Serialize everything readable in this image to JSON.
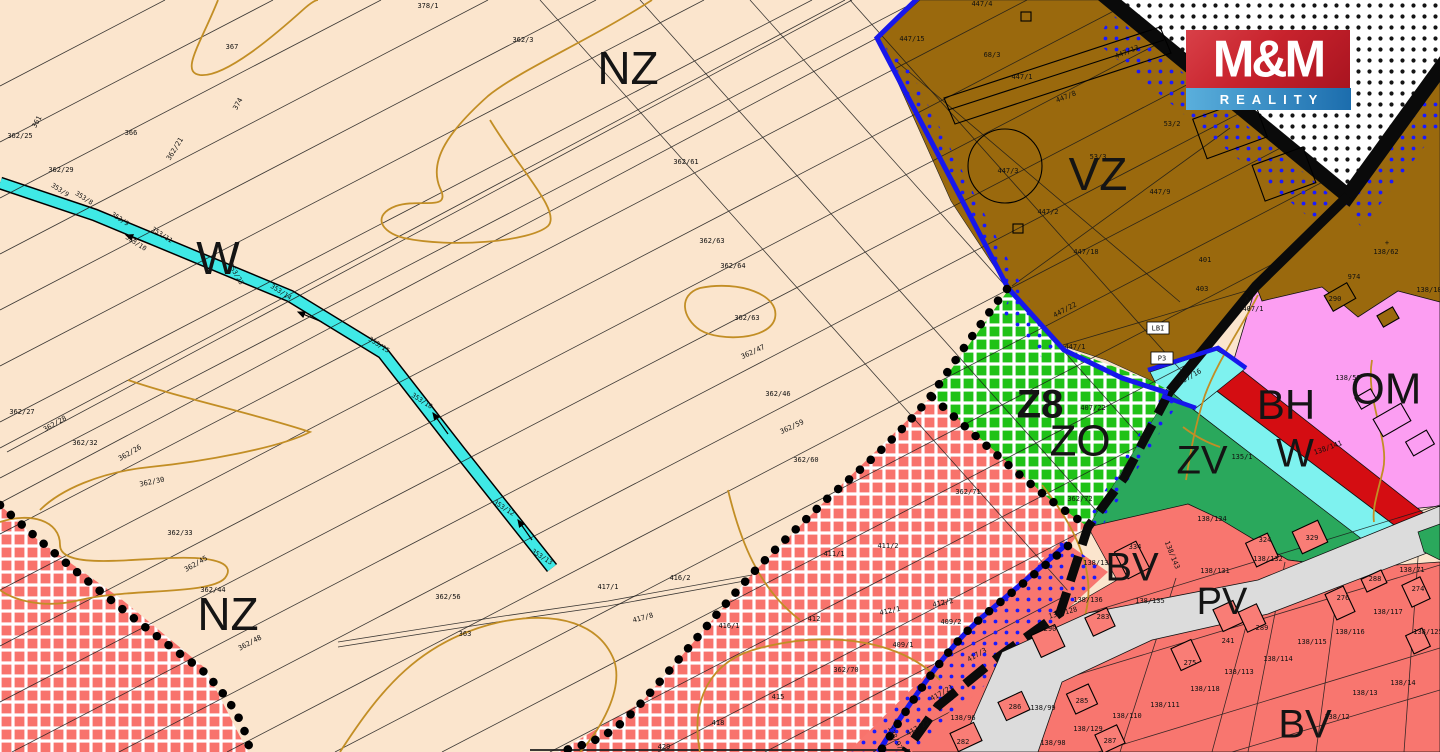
{
  "app": {
    "title": "Zoning plan map with realty watermark"
  },
  "logo": {
    "line1": "M&M",
    "line2": "REALITY"
  },
  "colors": {
    "beige": "#fbe5cd",
    "brown_vz": "#9a690d",
    "green_hatch_zo": "#1fc217",
    "green_solid_zv": "#2aa85c",
    "red_hatch": "#f8736c",
    "salmon_bv": "#f8766f",
    "pink_om": "#fc9ef2",
    "red_band_bh": "#d40d12",
    "cyan_stream": "#3fe9e6",
    "cyan_band_w": "#7ef2ef",
    "gray_road_pv": "#dcdcdc",
    "contour_gold": "#c28e25",
    "blue_border": "#1717ec",
    "magenta_z8": "#e312cf",
    "logo_red": "#c8232d",
    "logo_blue1": "#5aafdc",
    "logo_blue2": "#1c6dad"
  },
  "zone_labels": [
    {
      "t": "NZ",
      "x": 628,
      "y": 72,
      "s": 46
    },
    {
      "t": "NZ",
      "x": 228,
      "y": 618,
      "s": 46
    },
    {
      "t": "W",
      "x": 218,
      "y": 262,
      "s": 46
    },
    {
      "t": "VZ",
      "x": 1098,
      "y": 178,
      "s": 46
    },
    {
      "t": "Z8",
      "x": 1040,
      "y": 407,
      "s": 40,
      "c": "#e312cf",
      "w": "bold"
    },
    {
      "t": "ZO",
      "x": 1080,
      "y": 444,
      "s": 44
    },
    {
      "t": "ZV",
      "x": 1202,
      "y": 463,
      "s": 40
    },
    {
      "t": "BH",
      "x": 1286,
      "y": 408,
      "s": 42
    },
    {
      "t": "W",
      "x": 1295,
      "y": 456,
      "s": 40
    },
    {
      "t": "OM",
      "x": 1386,
      "y": 392,
      "s": 44
    },
    {
      "t": "BV",
      "x": 1132,
      "y": 570,
      "s": 40
    },
    {
      "t": "PV",
      "x": 1222,
      "y": 604,
      "s": 38
    },
    {
      "t": "BV",
      "x": 1305,
      "y": 727,
      "s": 40
    }
  ],
  "parcel_labels": [
    {
      "t": "367",
      "x": 232,
      "y": 47
    },
    {
      "t": "378/1",
      "x": 428,
      "y": 6
    },
    {
      "t": "362/3",
      "x": 523,
      "y": 40
    },
    {
      "t": "366",
      "x": 131,
      "y": 133
    },
    {
      "t": "362/25",
      "x": 20,
      "y": 136
    },
    {
      "t": "361",
      "x": 37,
      "y": 122,
      "r": -62
    },
    {
      "t": "362/29",
      "x": 61,
      "y": 170
    },
    {
      "t": "362/21",
      "x": 175,
      "y": 149,
      "r": -58
    },
    {
      "t": "374",
      "x": 238,
      "y": 104,
      "r": -62
    },
    {
      "t": "362/61",
      "x": 686,
      "y": 162
    },
    {
      "t": "362/63",
      "x": 712,
      "y": 241
    },
    {
      "t": "362/64",
      "x": 733,
      "y": 266
    },
    {
      "t": "362/63",
      "x": 747,
      "y": 318
    },
    {
      "t": "362/47",
      "x": 753,
      "y": 352,
      "r": -25
    },
    {
      "t": "362/46",
      "x": 778,
      "y": 394
    },
    {
      "t": "362/59",
      "x": 792,
      "y": 427,
      "r": -25
    },
    {
      "t": "362/60",
      "x": 806,
      "y": 460
    },
    {
      "t": "362/27",
      "x": 22,
      "y": 412
    },
    {
      "t": "362/28",
      "x": 55,
      "y": 424,
      "r": -30
    },
    {
      "t": "362/32",
      "x": 85,
      "y": 443
    },
    {
      "t": "362/26",
      "x": 130,
      "y": 453,
      "r": -30
    },
    {
      "t": "362/30",
      "x": 152,
      "y": 482,
      "r": -12
    },
    {
      "t": "362/33",
      "x": 180,
      "y": 533
    },
    {
      "t": "362/45",
      "x": 196,
      "y": 564,
      "r": -30
    },
    {
      "t": "362/44",
      "x": 213,
      "y": 590
    },
    {
      "t": "362/48",
      "x": 250,
      "y": 643,
      "r": -28
    },
    {
      "t": "362/56",
      "x": 448,
      "y": 597
    },
    {
      "t": "363",
      "x": 465,
      "y": 634
    },
    {
      "t": "417/1",
      "x": 608,
      "y": 587
    },
    {
      "t": "416/2",
      "x": 680,
      "y": 578
    },
    {
      "t": "417/8",
      "x": 643,
      "y": 618,
      "r": -15
    },
    {
      "t": "416/1",
      "x": 729,
      "y": 626
    },
    {
      "t": "412",
      "x": 814,
      "y": 619
    },
    {
      "t": "411/1",
      "x": 834,
      "y": 554
    },
    {
      "t": "411/2",
      "x": 888,
      "y": 546
    },
    {
      "t": "412/1",
      "x": 890,
      "y": 611,
      "r": -12
    },
    {
      "t": "412/2",
      "x": 943,
      "y": 603,
      "r": -12
    },
    {
      "t": "409/2",
      "x": 951,
      "y": 622
    },
    {
      "t": "409/1",
      "x": 903,
      "y": 645
    },
    {
      "t": "362/70",
      "x": 846,
      "y": 670
    },
    {
      "t": "415",
      "x": 778,
      "y": 697
    },
    {
      "t": "418",
      "x": 718,
      "y": 723
    },
    {
      "t": "429",
      "x": 664,
      "y": 747
    },
    {
      "t": "362/71",
      "x": 968,
      "y": 492
    },
    {
      "t": "362/72",
      "x": 1080,
      "y": 499
    },
    {
      "t": "447/4",
      "x": 982,
      "y": 4
    },
    {
      "t": "447/15",
      "x": 912,
      "y": 39
    },
    {
      "t": "68/3",
      "x": 992,
      "y": 55
    },
    {
      "t": "447/1",
      "x": 1022,
      "y": 77
    },
    {
      "t": "447/8",
      "x": 1066,
      "y": 97,
      "r": -22
    },
    {
      "t": "447/13",
      "x": 1127,
      "y": 52,
      "r": -22
    },
    {
      "t": "53/2",
      "x": 1172,
      "y": 124
    },
    {
      "t": "53/3",
      "x": 1098,
      "y": 157
    },
    {
      "t": "447/9",
      "x": 1160,
      "y": 192
    },
    {
      "t": "447/3",
      "x": 1008,
      "y": 171
    },
    {
      "t": "447/2",
      "x": 1048,
      "y": 212
    },
    {
      "t": "447/18",
      "x": 1086,
      "y": 252
    },
    {
      "t": "447/1",
      "x": 1075,
      "y": 347
    },
    {
      "t": "401",
      "x": 1205,
      "y": 260
    },
    {
      "t": "447/22",
      "x": 1065,
      "y": 310,
      "r": -28
    },
    {
      "t": "407/22",
      "x": 1093,
      "y": 408
    },
    {
      "t": "407/16",
      "x": 1190,
      "y": 377,
      "r": -30
    },
    {
      "t": "403",
      "x": 1202,
      "y": 289
    },
    {
      "t": "Λ",
      "x": 1247,
      "y": 300
    },
    {
      "t": "407/1",
      "x": 1253,
      "y": 309
    },
    {
      "t": "974",
      "x": 1354,
      "y": 277
    },
    {
      "t": "+",
      "x": 1387,
      "y": 243
    },
    {
      "t": "138/62",
      "x": 1386,
      "y": 252
    },
    {
      "t": "138/18",
      "x": 1429,
      "y": 290
    },
    {
      "t": "290",
      "x": 1335,
      "y": 299
    },
    {
      "t": "138/59",
      "x": 1348,
      "y": 378
    },
    {
      "t": "138/141",
      "x": 1328,
      "y": 448,
      "r": -20
    },
    {
      "t": "135/1",
      "x": 1242,
      "y": 457
    },
    {
      "t": "138/143",
      "x": 1172,
      "y": 555,
      "r": 68
    },
    {
      "t": "138/134",
      "x": 1212,
      "y": 519
    },
    {
      "t": "324",
      "x": 1265,
      "y": 540
    },
    {
      "t": "329",
      "x": 1312,
      "y": 538
    },
    {
      "t": "138/132",
      "x": 1268,
      "y": 559
    },
    {
      "t": "138/131",
      "x": 1215,
      "y": 571
    },
    {
      "t": "138/137",
      "x": 1098,
      "y": 563
    },
    {
      "t": "334",
      "x": 1135,
      "y": 547
    },
    {
      "t": "138/136",
      "x": 1088,
      "y": 600
    },
    {
      "t": "138/135",
      "x": 1150,
      "y": 601
    },
    {
      "t": "283",
      "x": 1103,
      "y": 617
    },
    {
      "t": "290",
      "x": 1050,
      "y": 629
    },
    {
      "t": "138/128",
      "x": 1063,
      "y": 613,
      "r": -15
    },
    {
      "t": "275",
      "x": 1190,
      "y": 663
    },
    {
      "t": "241",
      "x": 1228,
      "y": 641
    },
    {
      "t": "289",
      "x": 1262,
      "y": 628
    },
    {
      "t": "288",
      "x": 1375,
      "y": 579
    },
    {
      "t": "276",
      "x": 1343,
      "y": 598
    },
    {
      "t": "274",
      "x": 1418,
      "y": 589
    },
    {
      "t": "138/117",
      "x": 1388,
      "y": 612
    },
    {
      "t": "138/71",
      "x": 1412,
      "y": 570
    },
    {
      "t": "138/116",
      "x": 1350,
      "y": 632
    },
    {
      "t": "138/115",
      "x": 1312,
      "y": 642
    },
    {
      "t": "138/114",
      "x": 1278,
      "y": 659
    },
    {
      "t": "138/113",
      "x": 1239,
      "y": 672
    },
    {
      "t": "138/14",
      "x": 1403,
      "y": 683
    },
    {
      "t": "138/13",
      "x": 1365,
      "y": 693
    },
    {
      "t": "138/12",
      "x": 1337,
      "y": 717
    },
    {
      "t": "138/125",
      "x": 1428,
      "y": 632
    },
    {
      "t": "138/110",
      "x": 1127,
      "y": 716
    },
    {
      "t": "138/129",
      "x": 1088,
      "y": 729
    },
    {
      "t": "138/111",
      "x": 1165,
      "y": 705
    },
    {
      "t": "138/118",
      "x": 1205,
      "y": 689
    },
    {
      "t": "138/96",
      "x": 963,
      "y": 718
    },
    {
      "t": "138/97",
      "x": 895,
      "y": 738,
      "r": 65
    },
    {
      "t": "138/98",
      "x": 1053,
      "y": 743
    },
    {
      "t": "138/99",
      "x": 1043,
      "y": 708
    },
    {
      "t": "286",
      "x": 1015,
      "y": 707
    },
    {
      "t": "282",
      "x": 963,
      "y": 742
    },
    {
      "t": "285",
      "x": 1082,
      "y": 701
    },
    {
      "t": "287",
      "x": 1110,
      "y": 741
    },
    {
      "t": "417/3",
      "x": 977,
      "y": 655,
      "r": -30
    },
    {
      "t": "417/21",
      "x": 942,
      "y": 693,
      "r": -30
    },
    {
      "t": "417/22",
      "x": 918,
      "y": 728,
      "r": -30
    }
  ],
  "stream_labels": [
    {
      "t": "353/9",
      "x": 60,
      "y": 190
    },
    {
      "t": "353/8",
      "x": 84,
      "y": 198
    },
    {
      "t": "353/9",
      "x": 120,
      "y": 219
    },
    {
      "t": "353/11",
      "x": 162,
      "y": 235
    },
    {
      "t": "353/10",
      "x": 136,
      "y": 243
    },
    {
      "t": "353/23",
      "x": 236,
      "y": 274,
      "r": 60
    },
    {
      "t": "353/14",
      "x": 281,
      "y": 292
    },
    {
      "t": "353/15",
      "x": 379,
      "y": 345
    },
    {
      "t": "353/10",
      "x": 422,
      "y": 401
    },
    {
      "t": "353/12",
      "x": 504,
      "y": 508
    },
    {
      "t": "353/13",
      "x": 542,
      "y": 557
    }
  ],
  "boxed_labels": [
    {
      "t": "LBI",
      "x": 1158,
      "y": 328
    },
    {
      "t": "P3",
      "x": 1162,
      "y": 358
    }
  ]
}
